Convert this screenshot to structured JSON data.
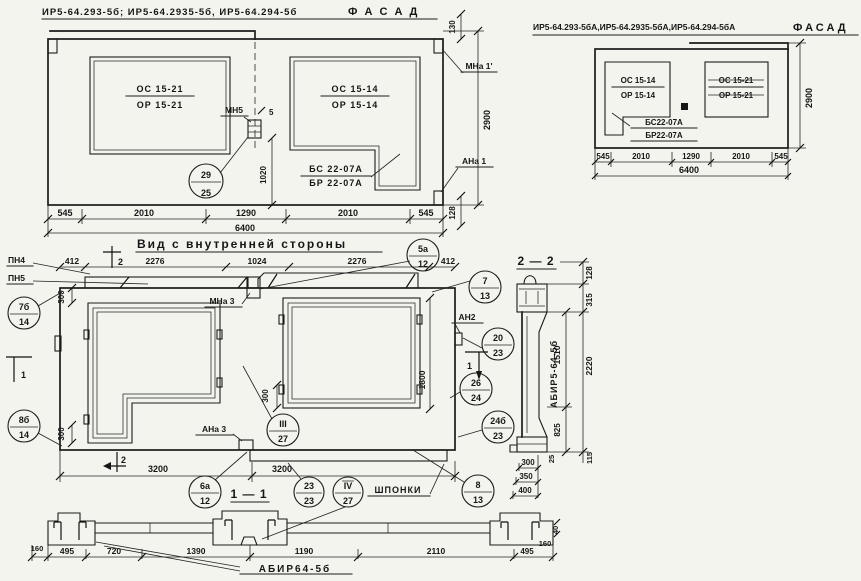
{
  "f1": {
    "title": "ИР5-64.293-5б; ИР5-64.2935-5б, ИР5-64.294-5б",
    "fasad": "Ф А С А Д",
    "wl_num": "ОС 15-21",
    "wl_den": "ОР 15-21",
    "wr_num": "ОС 15-14",
    "wr_den": "ОР 15-14",
    "b_num": "БС 22-07А",
    "b_den": "БР 22-07А",
    "mn5": "МН5",
    "mna1": "МНа 1'",
    "ana1": "АНа 1",
    "c29": {
      "t": "29",
      "b": "25"
    },
    "d130": "130",
    "d2900": "2900",
    "d128": "128",
    "d1020": "1020",
    "d5": "5",
    "row": [
      "545",
      "2010",
      "1290",
      "2010",
      "545"
    ],
    "total": "6400"
  },
  "f2": {
    "title": "ИР5-64.293-5бА,ИР5-64.2935-5бА,ИР5-64.294-5бА",
    "fasad": "ФАСАД",
    "wl_num": "ОС 15-14",
    "wl_den": "ОР 15-14",
    "wr_num": "ОС 15-21",
    "wr_den": "ОР 15-21",
    "b_num": "БС22-07А",
    "b_den": "БР22-07А",
    "d2900": "2900",
    "row": [
      "545",
      "2010",
      "1290",
      "2010",
      "545"
    ],
    "total": "6400"
  },
  "iv": {
    "title": "Вид с внутренней стороны",
    "pn4": "ПН4",
    "pn5": "ПН5",
    "mna3": "МНа 3",
    "ana3": "АНа 3",
    "an2": "АН2",
    "row": [
      "412",
      "2276",
      "1024",
      "2276",
      "412"
    ],
    "d300": "300",
    "d1800": "1800",
    "d3200": "3200",
    "s1": "1",
    "s2": "2",
    "c5a": {
      "t": "5а",
      "b": "12"
    },
    "c7": {
      "t": "7",
      "b": "13"
    },
    "c7b": {
      "t": "7б",
      "b": "14"
    },
    "c8b": {
      "t": "8б",
      "b": "14"
    },
    "c20": {
      "t": "20",
      "b": "23"
    },
    "c26": {
      "t": "26",
      "b": "24"
    },
    "c24b": {
      "t": "24б",
      "b": "23"
    },
    "c8": {
      "t": "8",
      "b": "13"
    },
    "c3": {
      "t": "III",
      "b": "27"
    }
  },
  "s22": {
    "title": "2 — 2",
    "label": "АБИР5-64-5б",
    "d128": "128",
    "d315": "315",
    "d1510": "1510",
    "d2220": "2220",
    "d825": "825",
    "d25": "25",
    "d115": "115",
    "d300": "300",
    "d350": "350",
    "d400": "400"
  },
  "s11": {
    "title": "1 — 1",
    "label": "АБИР64-5б",
    "shponki": "ШПОНКИ",
    "c6a": {
      "t": "6а",
      "b": "12"
    },
    "c23": {
      "t": "23",
      "b": "23"
    },
    "c4": {
      "t": "IV",
      "b": "27"
    },
    "row": [
      "495",
      "720",
      "1390",
      "1190",
      "2110",
      "495"
    ],
    "d160l": "160",
    "d160r": "160",
    "d40": "40"
  }
}
